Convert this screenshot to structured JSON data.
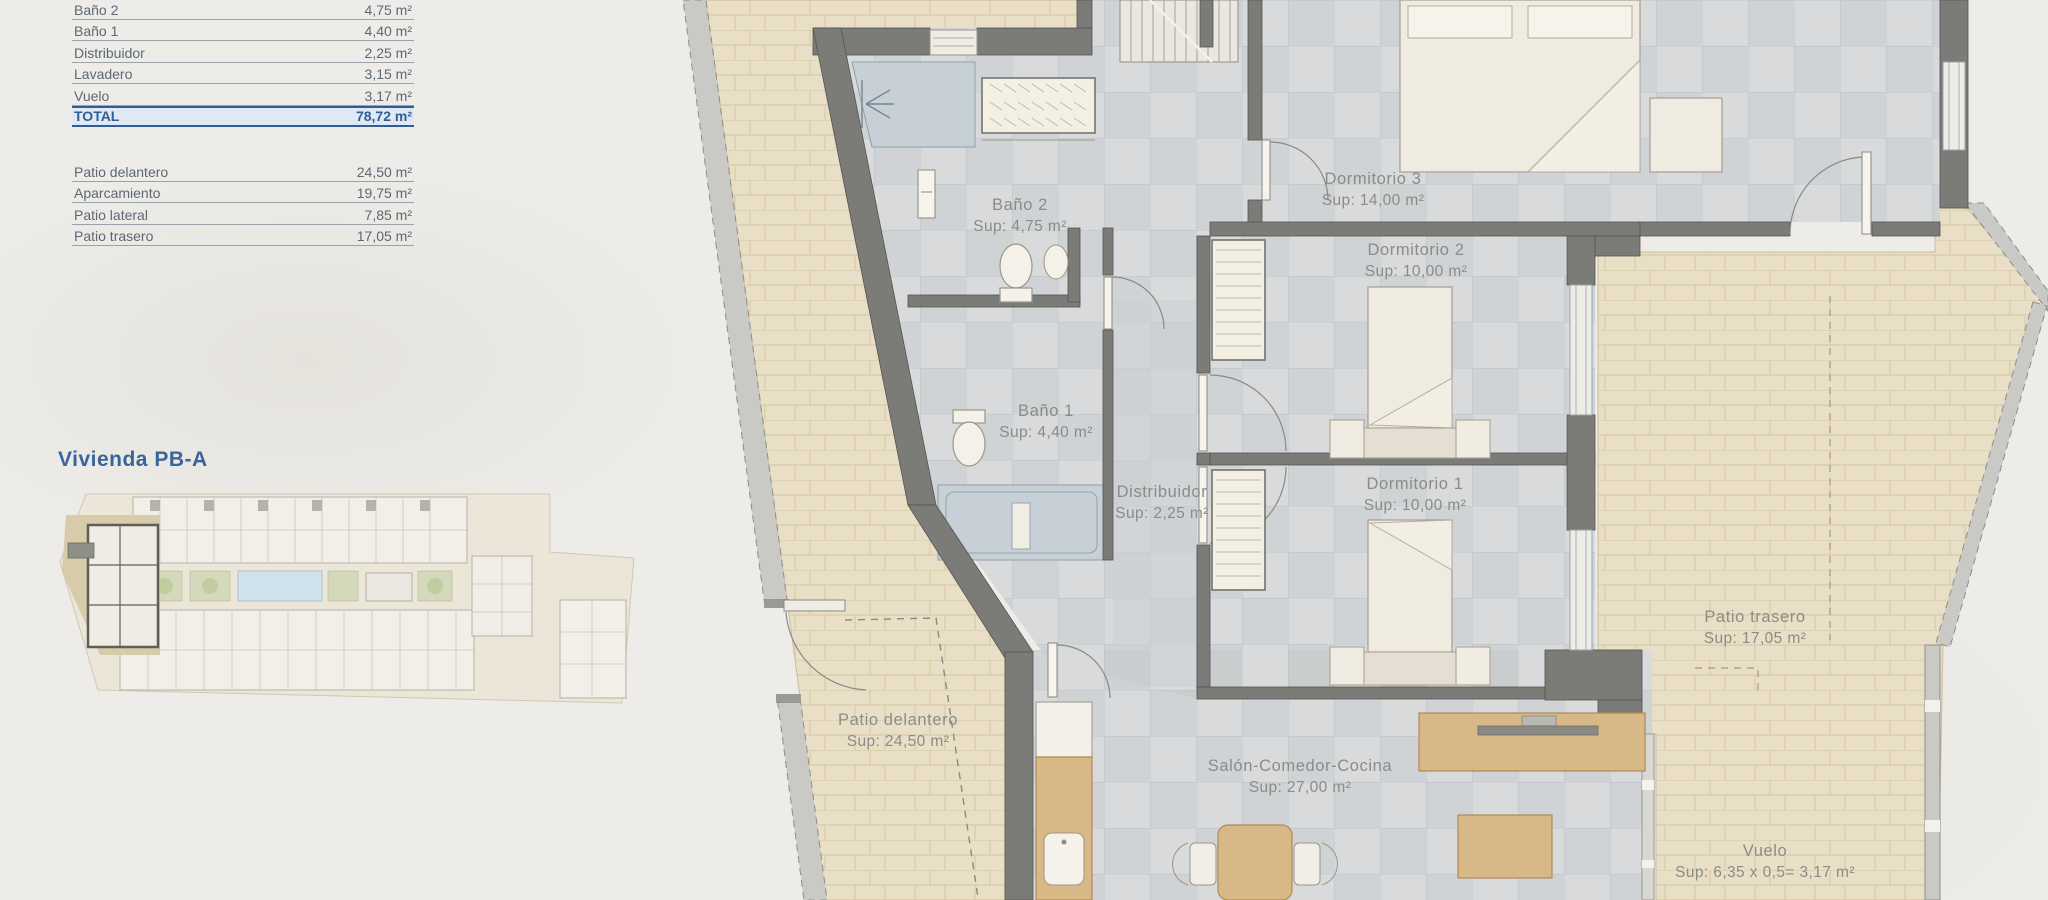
{
  "title": "Vivienda PB-A",
  "area_table": {
    "interior_rows": [
      {
        "label": "Baño 2",
        "value": "4,75 m²"
      },
      {
        "label": "Baño 1",
        "value": "4,40 m²"
      },
      {
        "label": "Distribuidor",
        "value": "2,25 m²"
      },
      {
        "label": "Lavadero",
        "value": "3,15 m²"
      },
      {
        "label": "Vuelo",
        "value": "3,17 m²"
      }
    ],
    "total": {
      "label": "TOTAL",
      "value": "78,72 m²"
    },
    "exterior_rows": [
      {
        "label": "Patio delantero",
        "value": "24,50 m²"
      },
      {
        "label": "Aparcamiento",
        "value": "19,75 m²"
      },
      {
        "label": "Patio lateral",
        "value": "7,85 m²"
      },
      {
        "label": "Patio trasero",
        "value": "17,05 m²"
      }
    ]
  },
  "plan_labels": {
    "bano2": {
      "name": "Baño 2",
      "sup": "Sup: 4,75 m²"
    },
    "bano1": {
      "name": "Baño 1",
      "sup": "Sup: 4,40 m²"
    },
    "distribuidor": {
      "name": "Distribuidor",
      "sup": "Sup: 2,25 m²"
    },
    "dormitorio3": {
      "name": "Dormitorio 3",
      "sup": "Sup: 14,00 m²"
    },
    "dormitorio2": {
      "name": "Dormitorio 2",
      "sup": "Sup: 10,00 m²"
    },
    "dormitorio1": {
      "name": "Dormitorio 1",
      "sup": "Sup: 10,00 m²"
    },
    "salon": {
      "name": "Salón-Comedor-Cocina",
      "sup": "Sup: 27,00 m²"
    },
    "patio_delantero": {
      "name": "Patio delantero",
      "sup": "Sup: 24,50 m²"
    },
    "patio_trasero": {
      "name": "Patio trasero",
      "sup": "Sup: 17,05 m²"
    },
    "vuelo": {
      "name": "Vuelo",
      "sup": "Sup: 6,35 x 0,5= 3,17 m²"
    }
  },
  "colors": {
    "accent_blue": "#2f5e96",
    "wall_gray": "#7b7b78",
    "brick_beige": "#e9dfc6",
    "tile_gray": "#d8dadc",
    "bath_blue": "#c6d0d6",
    "wood": "#d9b888"
  }
}
